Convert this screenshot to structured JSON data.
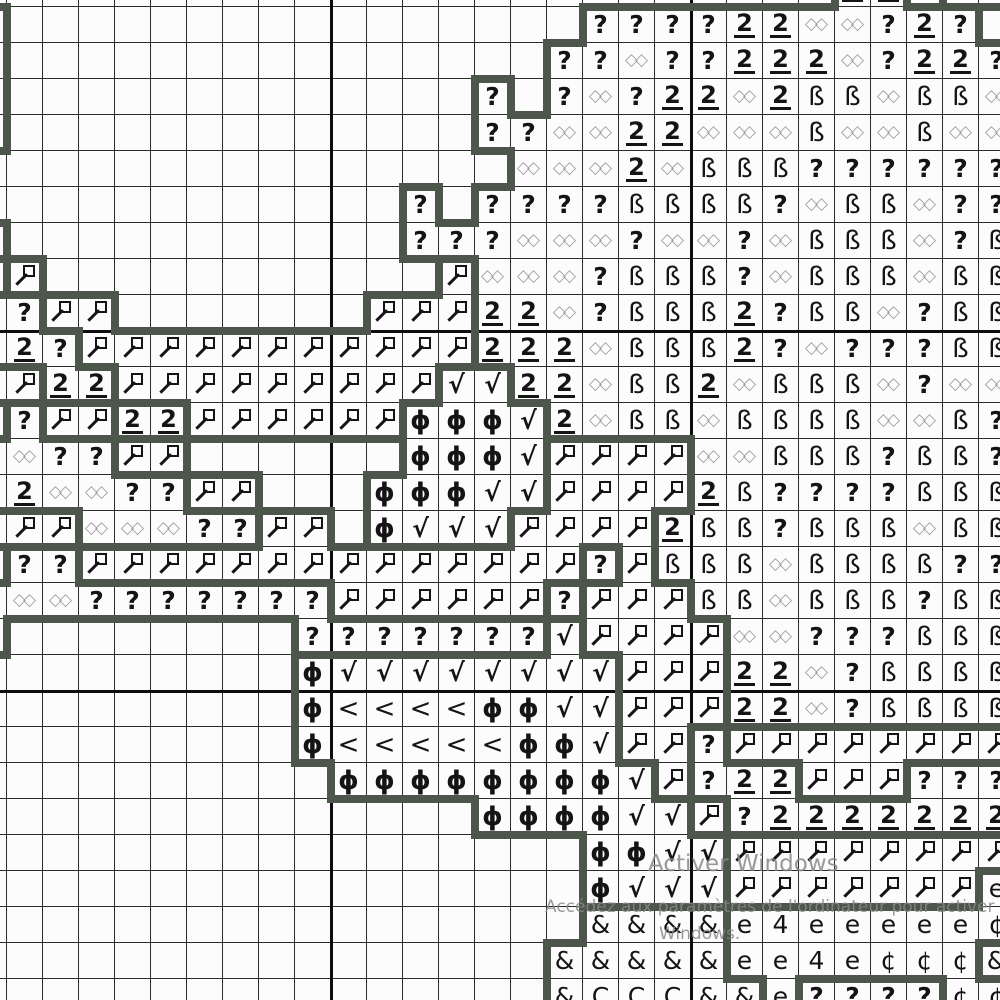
{
  "chart": {
    "type": "cross-stitch-symbol-chart",
    "cell_size": 36,
    "origin_x": -29,
    "origin_y": -29,
    "cols": 29,
    "rows": 29,
    "major_gridline_positions_px": {
      "vertical": [
        331,
        691
      ],
      "horizontal": [
        331,
        691
      ]
    },
    "colors": {
      "background": "#fcfcfc",
      "grid_line": "#2b2b2b",
      "major_grid_line": "#0e0e0e",
      "region_outline": "#4d564a",
      "symbol": "#141414",
      "infinity_symbol": "#a2a2a2",
      "watermark": "#878787"
    },
    "legend": {
      "Q": "?",
      "2": "2",
      "I": "◇◇",
      "B": "ß",
      "M": "magnifier",
      "K": "√",
      "P": "ϕ",
      "L": "<",
      "A": "&",
      "C": "Ç",
      "c": "¢",
      "4": "4",
      "E": "e",
      "H": "",
      ".": ""
    },
    "region_class_of_symbol": {
      ".": 0,
      "H": 1,
      "Q": 1,
      "2": 1,
      "I": 1,
      "B": 1,
      "M": 2,
      "P": 3,
      "K": 3,
      "L": 3,
      "A": 4,
      "C": 4,
      "E": 5,
      "4": 5,
      "c": 5
    },
    "grid_rows": [
      "........................22.MM",
      "H................QQQQ22IIQ2Q.",
      "H...............QQIQQ222IQ22Q",
      "H.............Q.QIQ22I2BBIBBI",
      "H.............QQII22IIIBIIBII",
      "...............III2IBBBQQQQQQ",
      "............Q.QQQQBBBBQIBBIQQ",
      "M...........QQQIIIQIIQIBBBIQB",
      ".M...........MIIIQBBBQIBBBIBB",
      "IQMM.......MMM22IQBBB2QBBIQBB",
      "22QMMMMMMMMMMM222IBBB2QIQQQBB",
      "MM22MMMMMMMMMKK22IBB2IBBBIQII",
      ".QMM22MMMMMMPPPK2IBBIBBBBIIBQ",
      "IIQQMM......PPPKMMMMIIBBBQBBQ",
      "22IIQQMM...PPPKKMMMM2BQQQQBBB",
      "MMMIIIQQMM.PKKKMMMM2BBQBBBIBB",
      ".QQMMMMMMMMMMMMMMQMBBBIBBBBQQ",
      "2IIQQQQQQQMMMMMMQMMMBBIBBBQBB",
      "I........QQQQQQQKMMMMIIQQQBBB",
      ".........PKKKKKKKKMMM22IQBBBB",
      ".........PLLLLPPKKMMM22IQBBBB",
      ".........PLLLLLPPKMMQMMMMMMMM",
      "..........PPPPPPPPKMQ22MMMQQQ",
      "..............PPPPKKMQ2222222",
      ".................PPKKMMMMMMMM",
      ".................PKKKMMMMMMME",
      ".................AAAAE4EEEEEc",
      "................AAAAAEE4EcccA",
      "................ACCCAAEQQQQcc"
    ]
  },
  "watermark": {
    "line1": "Activer Windows",
    "line2": "Accédez aux paramètres de l'ordinateur pour activer",
    "line3": "Windows."
  }
}
